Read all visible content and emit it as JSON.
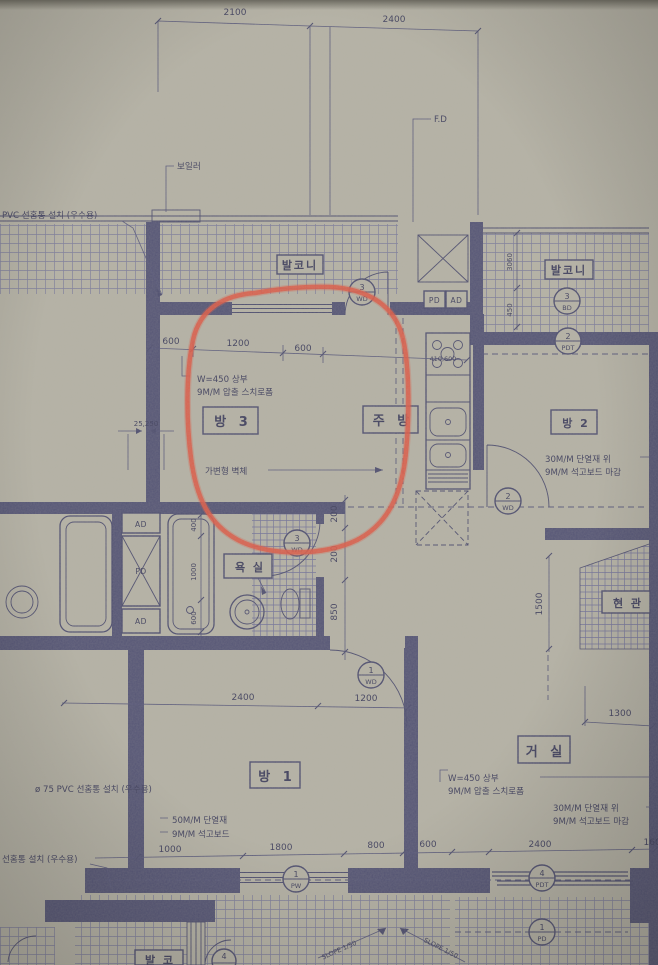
{
  "colors": {
    "paper": "#b6b3a6",
    "ink": "#4f4f70",
    "hatch": "#7a7a98",
    "red_marker": "#de5b47"
  },
  "rooms": {
    "room3": "방 3",
    "kitchen": "주 방",
    "room2": "방 2",
    "bath": "욕 실",
    "entry": "현 관",
    "living": "거 실",
    "room1": "방 1",
    "balcony_top": "발코니",
    "balcony_right": "발코니",
    "balcony_bottom": "발 코"
  },
  "shafts": {
    "ad_top": "AD",
    "pd_mid": "PD",
    "ad_bot": "AD",
    "pd_kitchen": "PD",
    "ad_kitchen": "AD"
  },
  "notes": {
    "boiler": "보일러",
    "fd": "F.D",
    "pvc_left": "PVC 선홈통 설치 (우수용)",
    "w450_a": "W=450 상부",
    "w450_b": "9M/M 압출 스치로폼",
    "movable_wall": "가변형 벽체",
    "ins30_a": "30M/M 단열재 위",
    "ins30_b": "9M/M 석고보드 마감",
    "pvc75": "ø 75 PVC 선홈통 설치 (우수용)",
    "ins50_a": "50M/M 단열재",
    "ins50_b": "9M/M 석고보드",
    "liv_w450_a": "W=450 상부",
    "liv_w450_b": "9M/M 압출 스치로폼",
    "liv_ins30_a": "30M/M 단열재 위",
    "liv_ins30_b": "9M/M 석고보드 마감",
    "pvc_bottom_left": "선홈통 설치 (우수용)",
    "slope1": "SLOPE 1/50",
    "slope2": "SLOPE 1/50"
  },
  "dims": {
    "top": [
      "2100",
      "2400"
    ],
    "kitchen": [
      "600",
      "1200",
      "600",
      "410,600"
    ],
    "vert": [
      "200",
      "200",
      "850"
    ],
    "tub": [
      "400",
      "1000",
      "600"
    ],
    "right": [
      "3060",
      "450"
    ],
    "entry": [
      "1500"
    ],
    "living": [
      "1300"
    ],
    "room1": [
      "2400",
      "1200"
    ],
    "bottom": [
      "1000",
      "1800",
      "800",
      "600",
      "2400",
      "1600"
    ],
    "wall": [
      "25,250"
    ]
  },
  "symbols": {
    "balcony_door": {
      "num": "3",
      "type": "WD"
    },
    "balcony_win_top": {
      "num": "3",
      "type": "BD"
    },
    "balcony_win_bot": {
      "num": "2",
      "type": "PDT"
    },
    "room2_door": {
      "num": "2",
      "type": "WD"
    },
    "bath_door": {
      "num": "3",
      "type": "WD"
    },
    "room1_door": {
      "num": "1",
      "type": "WD"
    },
    "room1_window": {
      "num": "1",
      "type": "PW"
    },
    "living_balcony_door": {
      "num": "4",
      "type": "PDT"
    },
    "balcony_bottom_door": {
      "num": "1",
      "type": "PD"
    },
    "partial_bottom": {
      "num": "4",
      "type": ""
    }
  }
}
